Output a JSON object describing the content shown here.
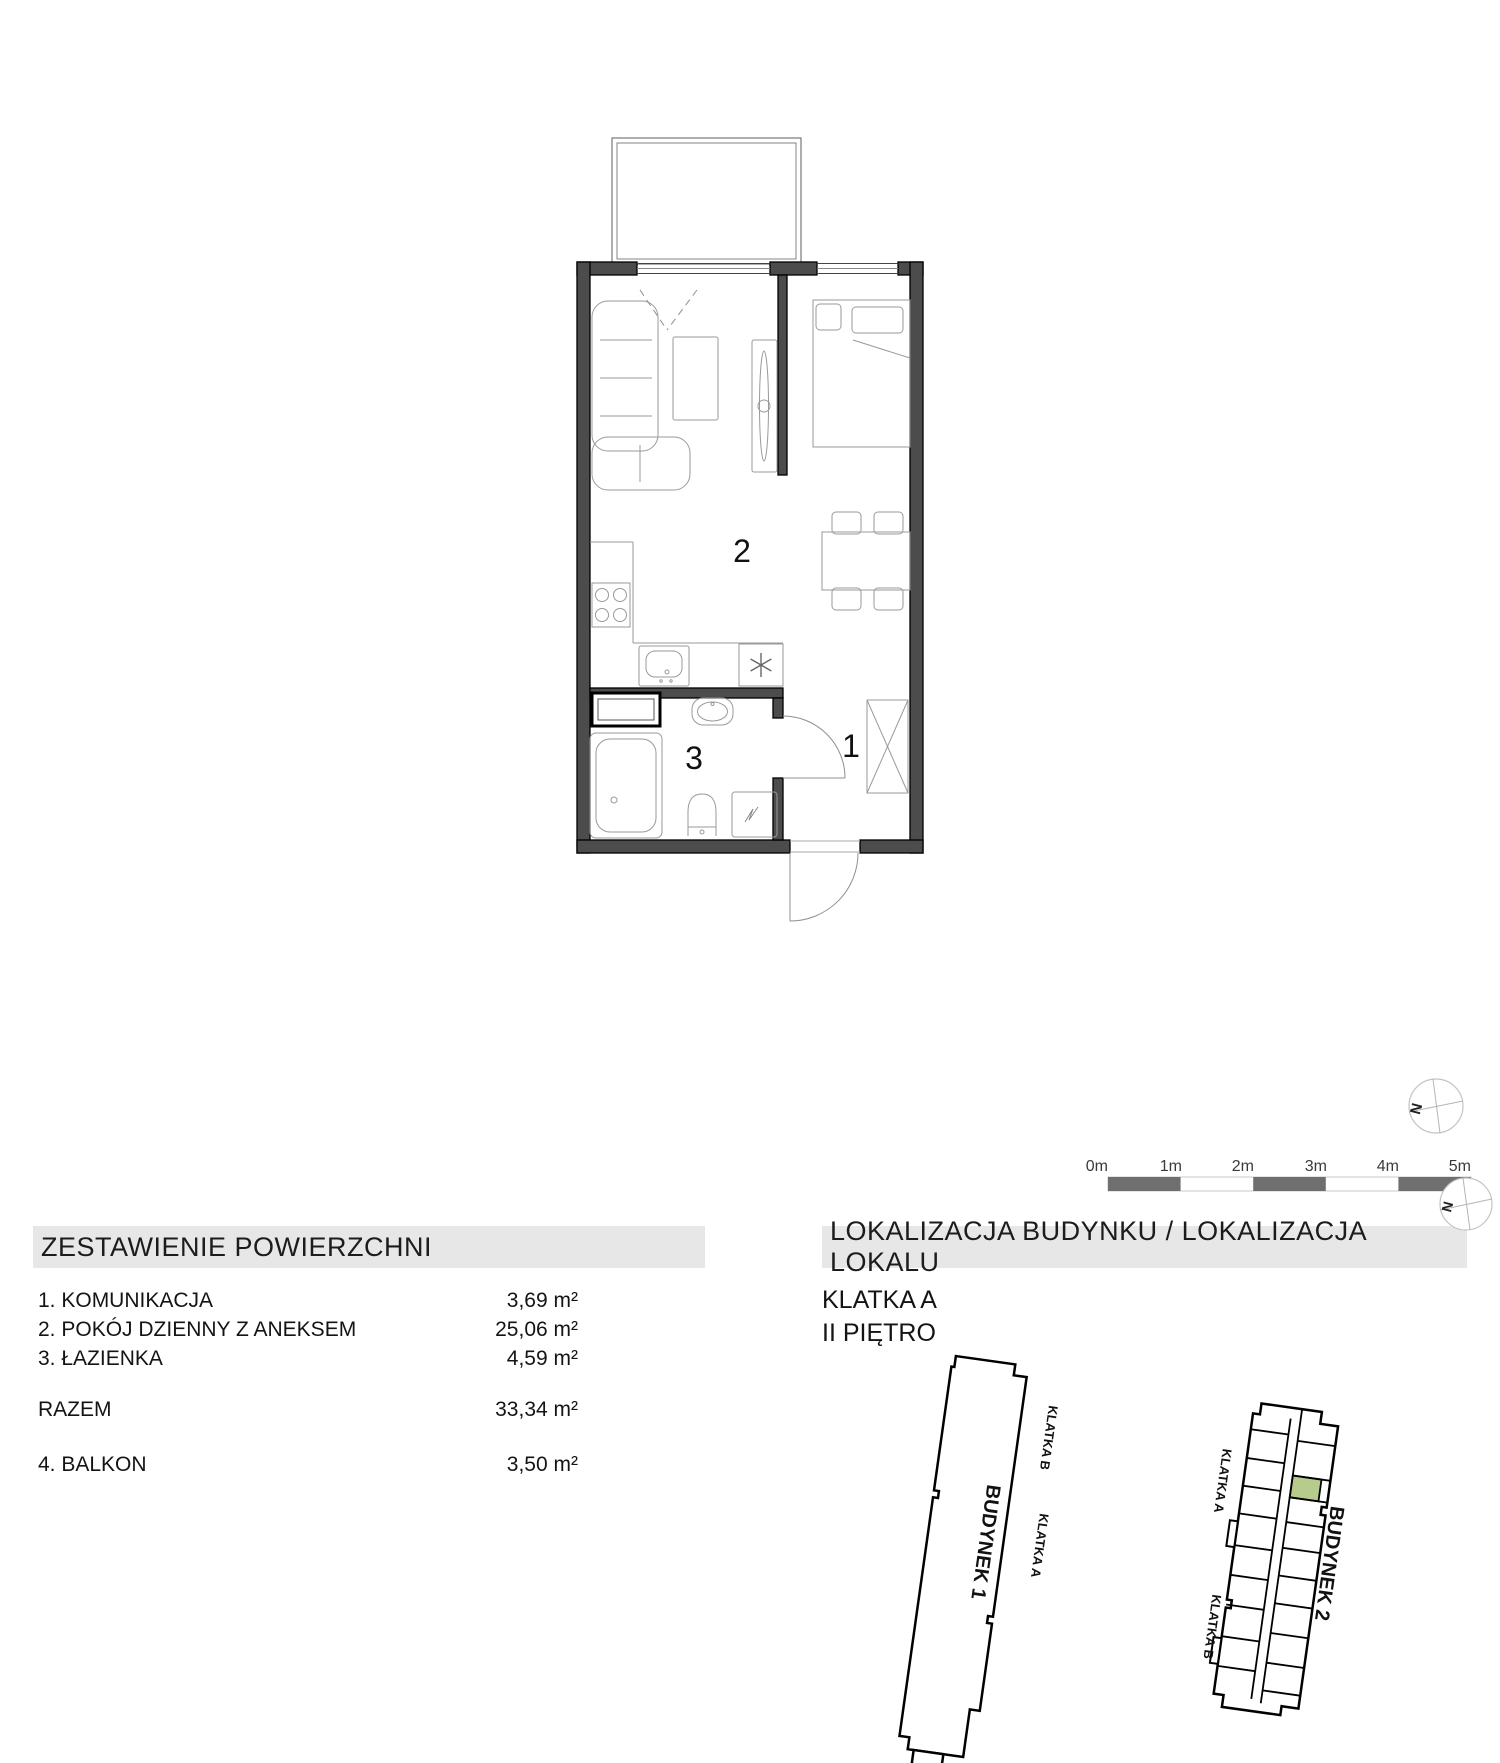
{
  "floor_plan": {
    "room_labels": [
      {
        "id": "hall",
        "label": "1"
      },
      {
        "id": "living",
        "label": "2"
      },
      {
        "id": "bath",
        "label": "3"
      }
    ]
  },
  "compasses": {
    "north_label": "N"
  },
  "scale_bar": {
    "labels": [
      "0m",
      "1m",
      "2m",
      "3m",
      "4m",
      "5m"
    ],
    "segment_color": "#6f6f6f"
  },
  "area_table": {
    "header": "ZESTAWIENIE POWIERZCHNI",
    "rows": [
      {
        "label": "1. KOMUNIKACJA",
        "value": "3,69 m²"
      },
      {
        "label": "2. POKÓJ DZIENNY Z ANEKSEM",
        "value": "25,06 m²"
      },
      {
        "label": "3. ŁAZIENKA",
        "value": "4,59 m²"
      }
    ],
    "total": {
      "label": "RAZEM",
      "value": "33,34 m²"
    },
    "balcony": {
      "label": "4. BALKON",
      "value": "3,50 m²"
    }
  },
  "location": {
    "header": "LOKALIZACJA BUDYNKU / LOKALIZACJA LOKALU",
    "staircase": "KLATKA A",
    "floor": "II PIĘTRO",
    "building1": {
      "name": "BUDYNEK 1",
      "klatka_a": "KLATKA A",
      "klatka_b": "KLATKA B"
    },
    "building2": {
      "name": "BUDYNEK 2",
      "klatka_a": "KLATKA A",
      "klatka_b": "KLATKA B"
    },
    "highlight_color": "#b7cb8d"
  },
  "colors": {
    "wall_fill": "#4c4c4c",
    "header_band": "#e7e7e7"
  }
}
